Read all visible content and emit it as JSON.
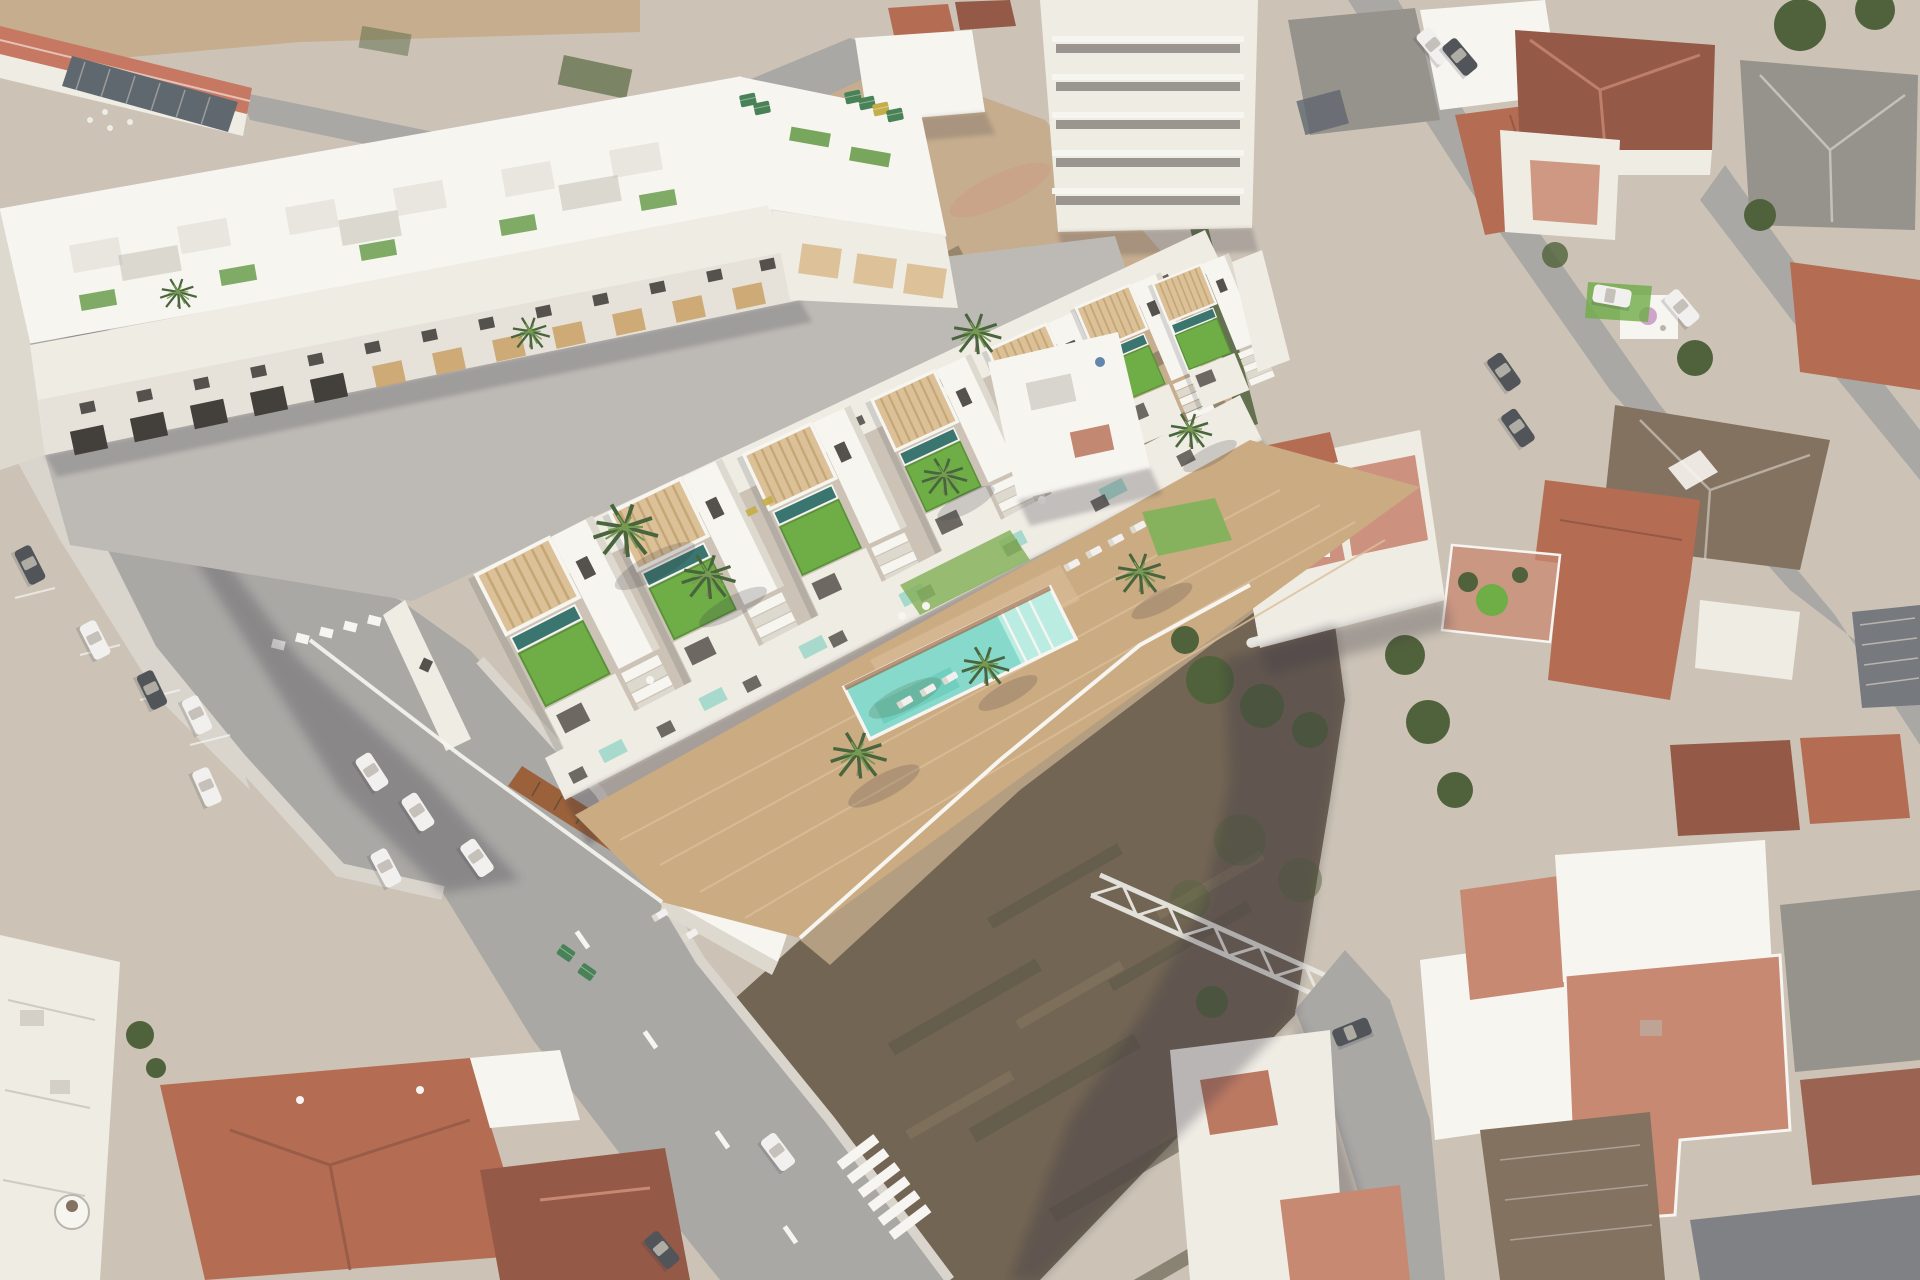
{
  "meta": {
    "title": "Aerial view of new-build townhouse development in a Spanish coastal town",
    "image_type": "oblique aerial photograph with 3D architectural render overlay",
    "text_present": false
  },
  "labels": {
    "caption": "Bird's-eye view of a white new-build residential complex: a three-storey apartment block and a row of seven townhouses with rooftop lawns, private plunge pools and timber pergolas, fronted by a wooden deck with a long turquoise communal pool and palm trees. Around it: two vacant dirt lots, gray streets with parked cars, dashed lane markings and a zebra crossing, and the terracotta and gray roofs of the existing town."
  },
  "palette": {
    "ground": "#c9c0b2",
    "sand": "#c2a887",
    "dirt_pink": "#c79e81",
    "dirt_olive": "#837257",
    "dirt_dark": "#6a5c4a",
    "dirt_deep": "#55503e",
    "road": "#a5a3a0",
    "road_light": "#b9b6b1",
    "sidewalk": "#d7d2c9",
    "marking": "#f6f5f1",
    "white_roof": "#f7f5f0",
    "white_wall": "#efebe3",
    "wall_shade": "#dcd7cd",
    "wall_dark": "#b6b1a7",
    "window": "#4b4741",
    "opening": "#38332e",
    "slat": "#c89f63",
    "slat_light": "#dbbf93",
    "pergola": "#d9bd92",
    "pergola_line": "#c2a26e",
    "deck": "#c8a67b",
    "deck_light": "#d8bc95",
    "corten": "#95582e",
    "lawn": "#66a83c",
    "lawn_dark": "#4f8c2c",
    "grass": "#7fae53",
    "tree": "#46592f",
    "palm": "#3e5c31",
    "palm_light": "#6f9448",
    "trunk": "#8a7a5e",
    "pool": "#7fd7c8",
    "pool_light": "#b7ebe0",
    "pool_deep": "#56c2b0",
    "plunge": "#2e6d66",
    "terracotta": "#b06449",
    "terracotta_light": "#c5826a",
    "terracotta_dark": "#8e4f3c",
    "red_roof": "#c4705a",
    "roof_brown": "#7d6a58",
    "roof_gray": "#908c85",
    "roof_slate": "#6e7277",
    "metal": "#565e67",
    "car_white": "#f1f0ed",
    "car_dark": "#474b4f",
    "bin_green": "#3e7b4d",
    "bin_yellow": "#c0a93e",
    "tarp": "#3f8878",
    "boat": "#e8e6e0",
    "shadow": "#2e2c38",
    "haze": "#ffffff",
    "umbrella": "#c9a0c6",
    "blue": "#5a7fa8"
  },
  "scene": {
    "sun_shadow_direction": "southeast",
    "development": {
      "rear_apartment_block": {
        "floors": 3,
        "small_facade_windows": 13,
        "garage_doors": 5,
        "timber_slat_panels": 7,
        "timber_balconies": 3,
        "roof": "terraces with white pergolas and lawn strips"
      },
      "townhouse_row": {
        "units": 7,
        "unit_features": [
          "timber slat pergola",
          "private plunge pool",
          "artificial lawn roof terrace",
          "white side staircase",
          "dark window slits"
        ]
      },
      "amenities": {
        "communal_pool": true,
        "pool_step_end": "northeast",
        "wood_deck": true,
        "sun_loungers": 9,
        "terrace_sofa_sets": 3,
        "palm_trees": 10,
        "corten_street_fence": true,
        "garage_entrance": true,
        "white_boundary_walls": true
      },
      "embedded_existing_house": true
    },
    "context": {
      "vacant_lots": 2,
      "streets": 6,
      "lane_dashes": 4,
      "zebra_crossing_bars": 6,
      "give_way_dashes": 6,
      "parked_vehicles": 14,
      "moving_cars": 1,
      "waste_containers": 8,
      "steel_truss_in_lot": true,
      "boat_in_lot": true,
      "pink_parasol": true,
      "existing_buildings": [
        "red-roof warehouse",
        "dark ribbed-roof shed",
        "white apartment tower with balconies",
        "terracotta hip-roof village houses",
        "white villas with tiled roof terraces"
      ],
      "vegetation": "palms, dark garden trees, dry scrub rows on vacant ground"
    }
  }
}
